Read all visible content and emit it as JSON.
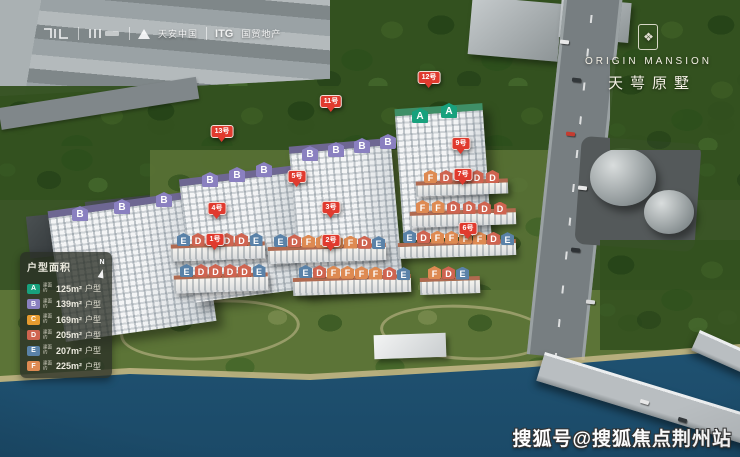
{
  "brand": {
    "name_en": "ORIGIN MANSION",
    "name_cn": "天萼原墅",
    "emblem_glyph": "❖"
  },
  "developer_logos": {
    "tianan_label": "天安中国",
    "itg_label": "ITG",
    "itg_sub_label": "国贸地产"
  },
  "legend": {
    "title": "户型面积",
    "compass_label": "N",
    "prefix_line1": "建面",
    "prefix_line2": "约",
    "suffix": "户型",
    "items": [
      {
        "letter": "A",
        "area": "125m²"
      },
      {
        "letter": "B",
        "area": "139m²"
      },
      {
        "letter": "C",
        "area": "169m²"
      },
      {
        "letter": "D",
        "area": "205m²"
      },
      {
        "letter": "E",
        "area": "207m²"
      },
      {
        "letter": "F",
        "area": "225m²"
      }
    ]
  },
  "type_colors": {
    "A": "#18a17d",
    "B": "#8a80c0",
    "C": "#e79b2f",
    "D": "#cf6450",
    "E": "#5a82a8",
    "F": "#de8a52"
  },
  "watermark": "搜狐号@搜狐焦点荆州站",
  "pins": [
    {
      "label": "13号",
      "x": 222,
      "y": 146
    },
    {
      "label": "11号",
      "x": 331,
      "y": 116
    },
    {
      "label": "12号",
      "x": 429,
      "y": 92
    },
    {
      "label": "9号",
      "x": 461,
      "y": 158
    },
    {
      "label": "7号",
      "x": 463,
      "y": 189
    },
    {
      "label": "5号",
      "x": 297,
      "y": 191
    },
    {
      "label": "4号",
      "x": 217,
      "y": 223
    },
    {
      "label": "3号",
      "x": 331,
      "y": 222
    },
    {
      "label": "6号",
      "x": 468,
      "y": 243
    },
    {
      "label": "1号",
      "x": 215,
      "y": 254
    },
    {
      "label": "2号",
      "x": 331,
      "y": 255
    }
  ],
  "towers": [
    {
      "letters": [
        "B",
        "B",
        "B"
      ],
      "x": 56,
      "y": 200,
      "w": 152,
      "h": 132,
      "rot": -8,
      "roof": "purple",
      "chip": {
        "x": 72,
        "y": 206,
        "dx": 42,
        "dy": -7
      }
    },
    {
      "letters": [
        "B",
        "B",
        "B"
      ],
      "x": 186,
      "y": 172,
      "w": 116,
      "h": 124,
      "rot": -7,
      "roof": "purple",
      "chip": {
        "x": 202,
        "y": 172,
        "dx": 27,
        "dy": -5
      }
    },
    {
      "letters": [
        "B",
        "B",
        "B",
        "B"
      ],
      "x": 295,
      "y": 142,
      "w": 102,
      "h": 148,
      "rot": -5,
      "roof": "purple",
      "chip": {
        "x": 302,
        "y": 146,
        "dx": 26,
        "dy": -4
      }
    },
    {
      "letters": [
        "A",
        "A"
      ],
      "x": 399,
      "y": 106,
      "w": 88,
      "h": 132,
      "rot": -4,
      "roof": "green",
      "chip": {
        "x": 412,
        "y": 108,
        "dx": 29,
        "dy": -5
      }
    }
  ],
  "rows": [
    {
      "letters": [
        "F",
        "D",
        "D",
        "D",
        "D"
      ],
      "x": 424,
      "y": 170,
      "dx": 15.5,
      "dy": 0,
      "strip": {
        "x": 416,
        "y": 180,
        "w": 92,
        "h": 15,
        "rot": -2
      }
    },
    {
      "letters": [
        "F",
        "F",
        "D",
        "D",
        "D",
        "D"
      ],
      "x": 416,
      "y": 200,
      "dx": 15.5,
      "dy": 0.3,
      "strip": {
        "x": 410,
        "y": 210,
        "w": 106,
        "h": 16,
        "rot": -2
      }
    },
    {
      "letters": [
        "E",
        "D",
        "F",
        "F",
        "F",
        "F",
        "D",
        "E"
      ],
      "x": 403,
      "y": 230,
      "dx": 14,
      "dy": 0.3,
      "strip": {
        "x": 398,
        "y": 241,
        "w": 118,
        "h": 16,
        "rot": -2
      }
    },
    {
      "letters": [
        "E",
        "D",
        "D",
        "D",
        "D",
        "E"
      ],
      "x": 177,
      "y": 233,
      "dx": 14.5,
      "dy": 0,
      "strip": {
        "x": 171,
        "y": 243,
        "w": 94,
        "h": 17,
        "rot": -2
      }
    },
    {
      "letters": [
        "E",
        "D",
        "F",
        "F",
        "F",
        "F",
        "D",
        "E"
      ],
      "x": 274,
      "y": 234,
      "dx": 14,
      "dy": 0.3,
      "strip": {
        "x": 268,
        "y": 245,
        "w": 118,
        "h": 17,
        "rot": -2
      }
    },
    {
      "letters": [
        "E",
        "D",
        "D",
        "D",
        "D",
        "E"
      ],
      "x": 180,
      "y": 264,
      "dx": 14.5,
      "dy": 0,
      "strip": {
        "x": 174,
        "y": 274,
        "w": 94,
        "h": 18,
        "rot": -2
      }
    },
    {
      "letters": [
        "E",
        "D",
        "F",
        "F",
        "F",
        "F",
        "D",
        "E"
      ],
      "x": 299,
      "y": 265,
      "dx": 14,
      "dy": 0.3,
      "strip": {
        "x": 293,
        "y": 276,
        "w": 118,
        "h": 18,
        "rot": -2
      }
    },
    {
      "letters": [
        "F",
        "D",
        "E"
      ],
      "x": 428,
      "y": 266,
      "dx": 14,
      "dy": 0.3,
      "strip": {
        "x": 420,
        "y": 277,
        "w": 60,
        "h": 17,
        "rot": -2
      }
    }
  ],
  "cars": [
    {
      "x": 560,
      "y": 40,
      "c": "#e8e8e8",
      "rot": 6
    },
    {
      "x": 572,
      "y": 78,
      "c": "#32373a",
      "rot": 6
    },
    {
      "x": 566,
      "y": 132,
      "c": "#c43c30",
      "rot": 6
    },
    {
      "x": 578,
      "y": 186,
      "c": "#e8e8e8",
      "rot": 6
    },
    {
      "x": 571,
      "y": 248,
      "c": "#2e3235",
      "rot": 6
    },
    {
      "x": 586,
      "y": 300,
      "c": "#d9d9d9",
      "rot": 6
    },
    {
      "x": 640,
      "y": 400,
      "c": "#e8e8e8",
      "rot": 17
    },
    {
      "x": 678,
      "y": 418,
      "c": "#33383b",
      "rot": 17
    }
  ]
}
